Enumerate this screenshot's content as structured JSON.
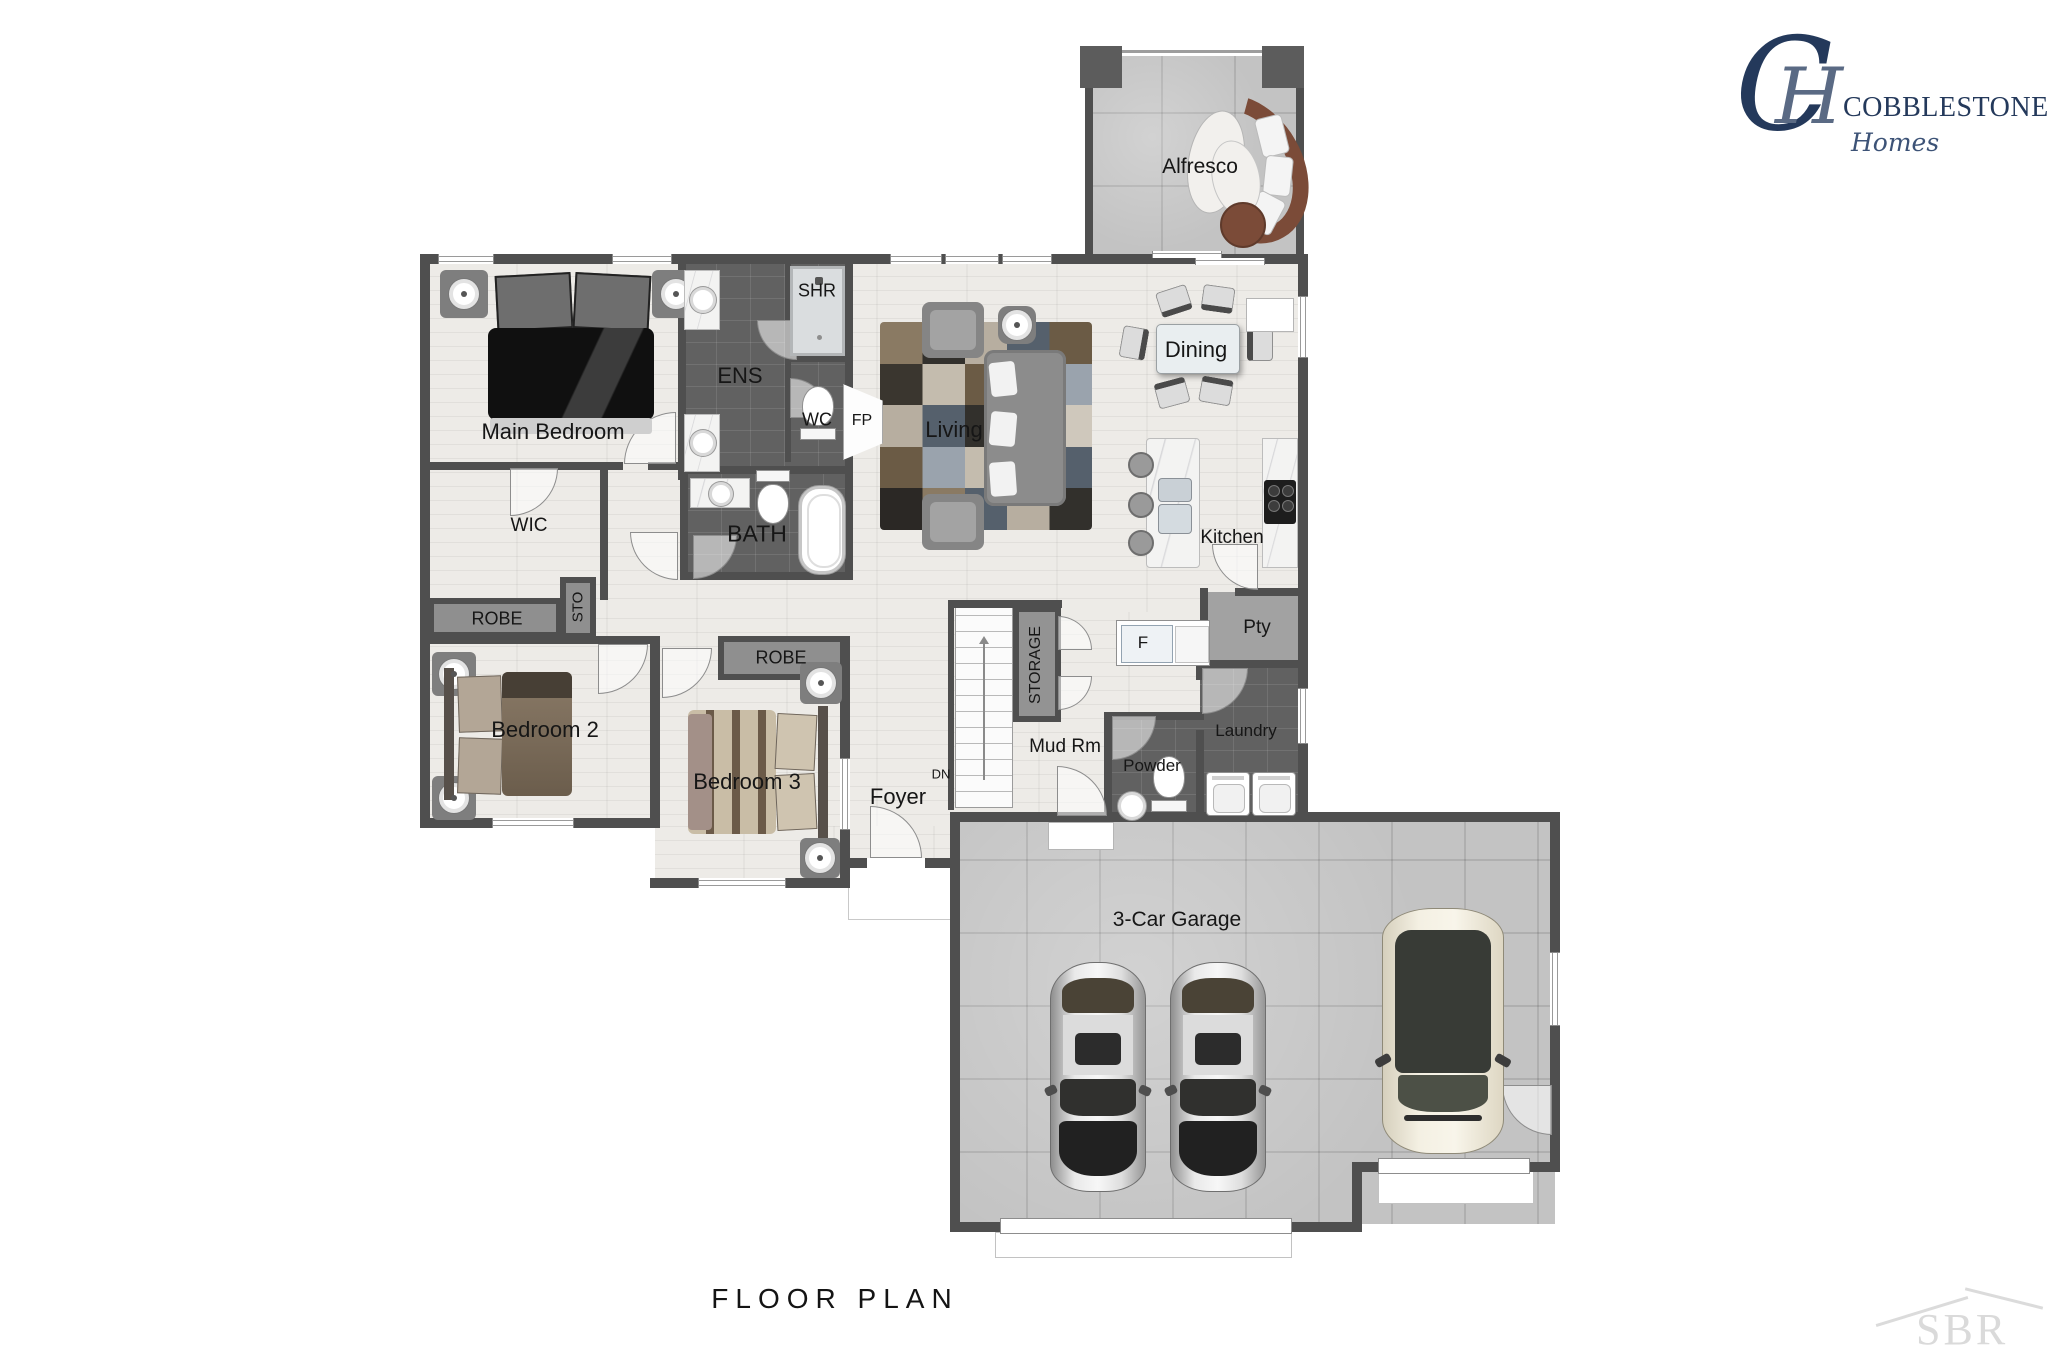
{
  "title": "FLOOR PLAN",
  "watermark": "SBR",
  "logo": {
    "monogram_c": "C",
    "monogram_h": "H",
    "name": "COBBLESTONE",
    "tagline": "Homes"
  },
  "colors": {
    "wall": "#4f4f4f",
    "wood": "#edebe7",
    "dark_tile": "#616161",
    "concrete": "#c3c3c3",
    "brand_navy": "#24395b"
  },
  "labels": {
    "alfresco": "Alfresco",
    "dining": "Dining",
    "living": "Living",
    "main_bedroom": "Main Bedroom",
    "ens": "ENS",
    "shr": "SHR",
    "wc": "WC",
    "fp": "FP",
    "wic": "WIC",
    "bath": "BATH",
    "sto": "STO",
    "robe_bed2": "ROBE",
    "robe_bed3": "ROBE",
    "bedroom2": "Bedroom 2",
    "bedroom3": "Bedroom 3",
    "foyer": "Foyer",
    "storage": "STORAGE",
    "dn": "DN",
    "mud_rm": "Mud Rm",
    "fridge": "F",
    "pantry": "Pty",
    "powder": "Powder",
    "laundry": "Laundry",
    "kitchen": "Kitchen",
    "garage": "3-Car Garage"
  }
}
